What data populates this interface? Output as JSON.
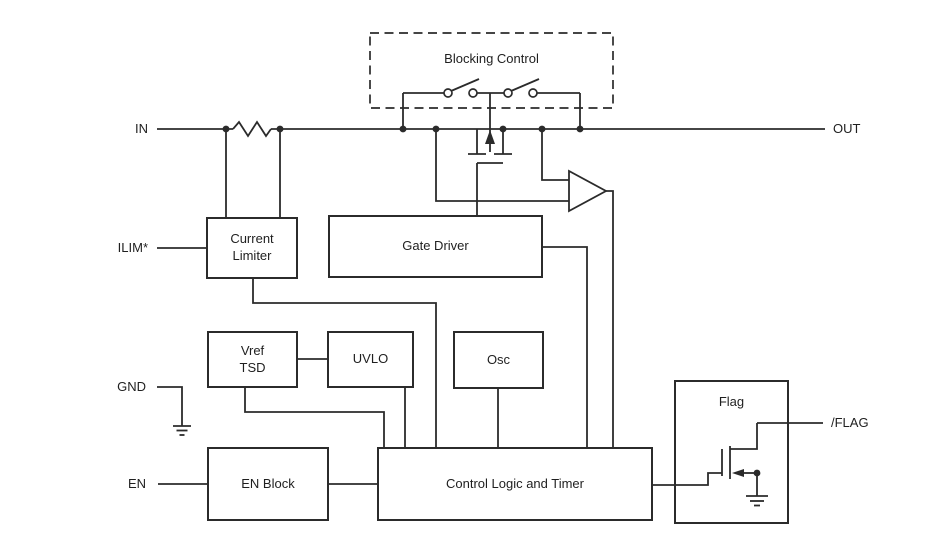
{
  "colors": {
    "line": "#2b2b2b",
    "text": "#1f1f1f",
    "background": "#ffffff"
  },
  "pins": {
    "in": "IN",
    "out": "OUT",
    "ilim": "ILIM*",
    "gnd": "GND",
    "en": "EN",
    "flag_out": "/FLAG"
  },
  "blocks": {
    "blocking_control": {
      "label": "Blocking Control"
    },
    "current_limiter": {
      "label": "Current\nLimiter"
    },
    "gate_driver": {
      "label": "Gate Driver"
    },
    "vref_tsd": {
      "label": "Vref\nTSD"
    },
    "uvlo": {
      "label": "UVLO"
    },
    "osc": {
      "label": "Osc"
    },
    "en_block": {
      "label": "EN Block"
    },
    "control_logic": {
      "label": "Control Logic and Timer"
    },
    "flag": {
      "label": "Flag"
    }
  }
}
